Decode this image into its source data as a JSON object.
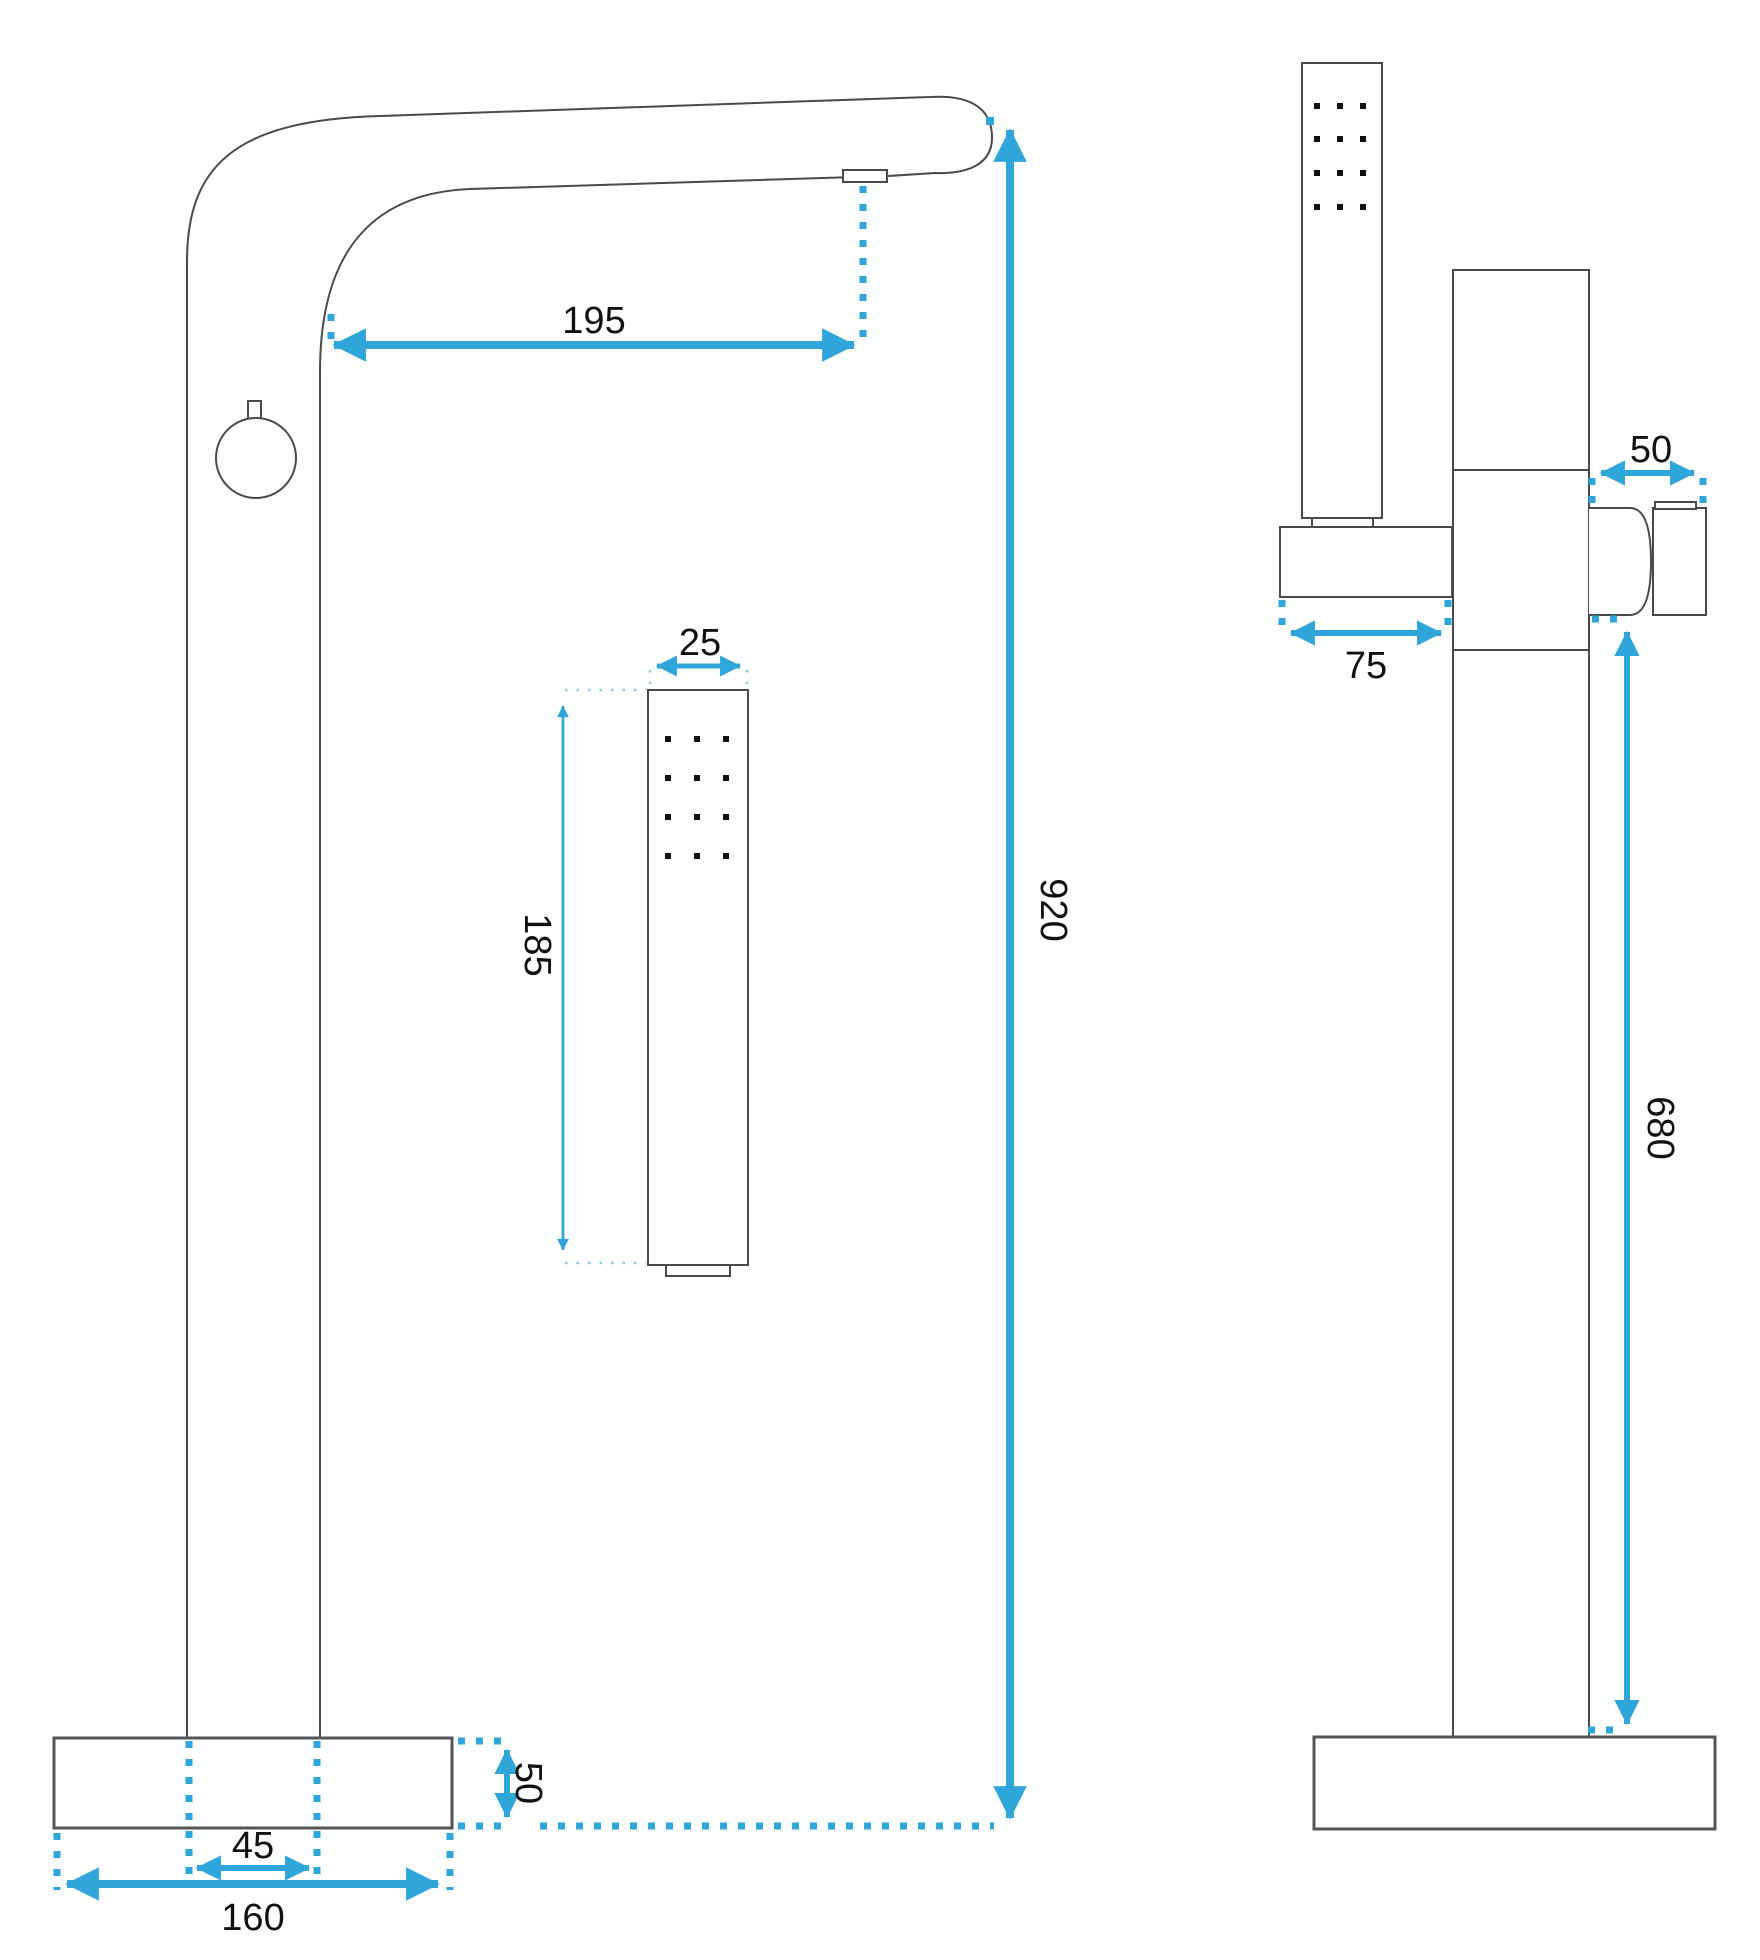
{
  "drawing": {
    "accent_color": "#2fa5d9",
    "line_color": "#4a4a4a",
    "front_view": {
      "dims": {
        "spout_reach": "195",
        "shower_width": "25",
        "shower_length": "185",
        "overall_height": "920",
        "base_thickness": "50",
        "column_width": "45",
        "base_width": "160"
      }
    },
    "side_view": {
      "dims": {
        "spout_depth": "50",
        "holder_length": "75",
        "spout_height": "680"
      }
    }
  }
}
